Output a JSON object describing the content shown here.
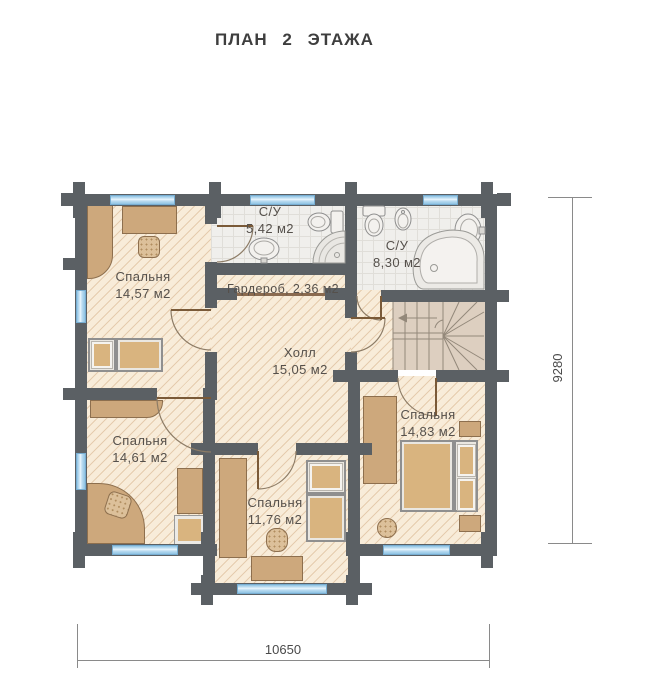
{
  "title": "ПЛАН 2 ЭТАЖА",
  "rooms": {
    "bedroom_top_left": {
      "name": "Спальня",
      "area": "14,57 м2"
    },
    "bathroom_small": {
      "name": "С/У",
      "area": "5,42 м2"
    },
    "bathroom_large": {
      "name": "С/У",
      "area": "8,30 м2"
    },
    "wardrobe": {
      "label": "Гардероб, 2,36 м2"
    },
    "hall": {
      "name": "Холл",
      "area": "15,05 м2"
    },
    "bedroom_bottom_left": {
      "name": "Спальня",
      "area": "14,61 м2"
    },
    "bedroom_bottom_center": {
      "name": "Спальня",
      "area": "11,76 м2"
    },
    "bedroom_bottom_right": {
      "name": "Спальня",
      "area": "14,83 м2"
    }
  },
  "dimensions": {
    "horizontal": "10650",
    "vertical": "9280"
  },
  "colors": {
    "wall": "#5b6064",
    "floor": "#f8ecd9",
    "hatch_line": "#dcb98f",
    "tile_floor": "#f0efec",
    "window": "#8ec3e4",
    "furniture": "#cda87c",
    "stairs_floor": "#ddcfc0",
    "title_text": "#3e3e3e",
    "label_text": "#55504b"
  }
}
